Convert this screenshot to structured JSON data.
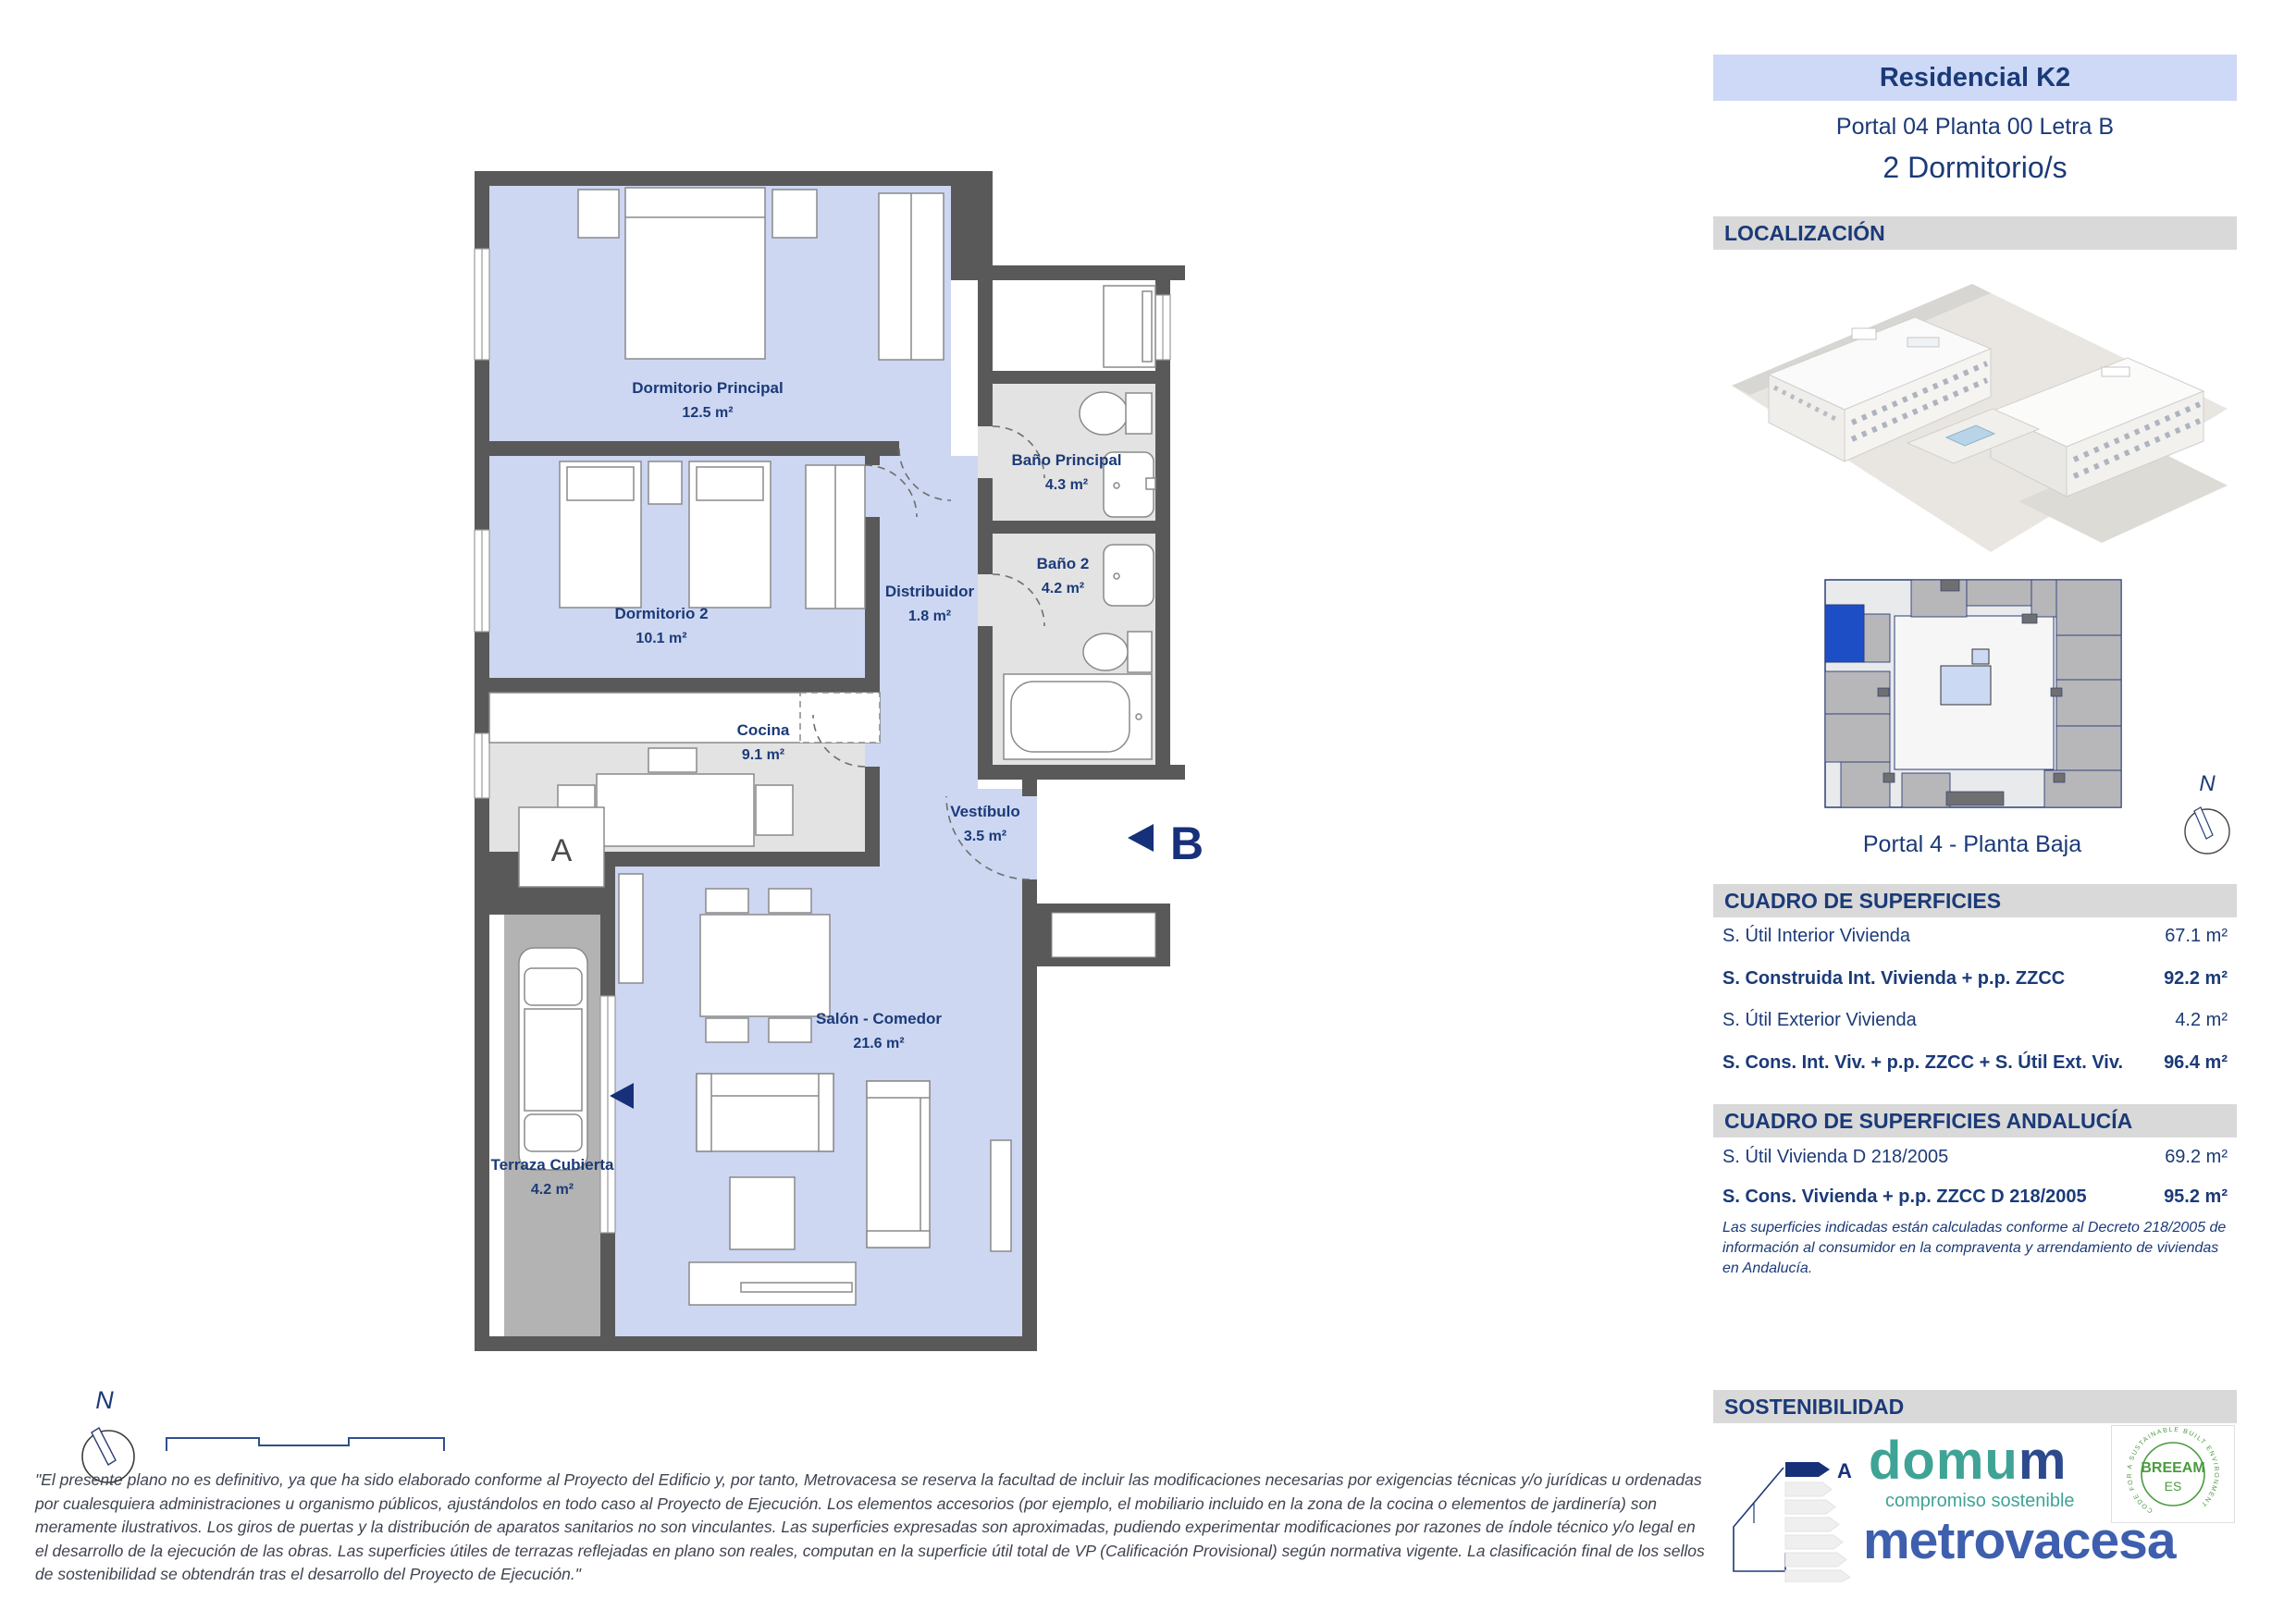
{
  "header": {
    "project": "Residencial K2",
    "unit": "Portal 04 Planta 00 Letra B",
    "bedrooms": "2 Dormitorio/s"
  },
  "sections": {
    "localizacion": "LOCALIZACIÓN",
    "superficies": "CUADRO DE SUPERFICIES",
    "superficies_andalucia": "CUADRO DE SUPERFICIES ANDALUCÍA",
    "sostenibilidad": "SOSTENIBILIDAD"
  },
  "keyplan": {
    "caption": "Portal 4 - Planta Baja",
    "north_label": "N"
  },
  "tables": {
    "main": {
      "rows": [
        {
          "label": "S. Útil Interior Vivienda",
          "value": "67.1 m²"
        },
        {
          "label": "S. Construida Int. Vivienda + p.p. ZZCC",
          "value": "92.2 m²"
        },
        {
          "label": "S. Útil Exterior Vivienda",
          "value": "4.2 m²"
        },
        {
          "label": "S. Cons. Int. Viv. + p.p. ZZCC + S. Útil Ext. Viv.",
          "value": "96.4 m²"
        }
      ]
    },
    "andalucia": {
      "rows": [
        {
          "label": "S. Útil Vivienda D 218/2005",
          "value": "69.2 m²"
        },
        {
          "label": "S. Cons. Vivienda + p.p. ZZCC D 218/2005",
          "value": "95.2 m²"
        }
      ],
      "note": "Las superficies indicadas están calculadas conforme al Decreto 218/2005 de información al consumidor en la compraventa y arrendamiento de viviendas en Andalucía."
    }
  },
  "plan": {
    "north_label": "N",
    "marker_a": "A",
    "marker_b": "B",
    "rooms": [
      {
        "name": "Dormitorio Principal",
        "area": "12.5 m²"
      },
      {
        "name": "Dormitorio 2",
        "area": "10.1 m²"
      },
      {
        "name": "Cocina",
        "area": "9.1 m²"
      },
      {
        "name": "Baño Principal",
        "area": "4.3 m²"
      },
      {
        "name": "Baño 2",
        "area": "4.2 m²"
      },
      {
        "name": "Distribuidor",
        "area": "1.8 m²"
      },
      {
        "name": "Vestíbulo",
        "area": "3.5 m²"
      },
      {
        "name": "Salón - Comedor",
        "area": "21.6 m²"
      },
      {
        "name": "Terraza Cubierta",
        "area": "4.2 m²"
      }
    ]
  },
  "logos": {
    "energy_class": "A",
    "domum": "domu",
    "domum_last": "m",
    "domum_sub": "compromiso sostenible",
    "breeam_line1": "BREEAM",
    "breeam_line2": "ES",
    "breeam_ring": "CODE FOR A SUSTAINABLE BUILT ENVIRONMENT",
    "metrovacesa": "metrovacesa"
  },
  "disclaimer": "\"El presente plano no es definitivo, ya que ha sido elaborado conforme al Proyecto del Edificio y, por tanto, Metrovacesa se reserva la facultad de incluir las modificaciones necesarias por exigencias técnicas y/o jurídicas u ordenadas por cualesquiera administraciones u organismo públicos, ajustándolos en todo caso al Proyecto de Ejecución. Los elementos accesorios (por ejemplo, el mobiliario incluido en la zona de la cocina o elementos de jardinería) son meramente ilustrativos. Los giros de puertas y la distribución de aparatos sanitarios no son vinculantes. Las superficies expresadas son aproximadas, pudiendo experimentar modificaciones por razones de índole técnico y/o legal en el desarrollo de la ejecución de las obras. Las superficies útiles de terrazas reflejadas en plano son reales, computan en la superficie útil total de VP (Calificación Provisional) según normativa vigente. La clasificación final de los sellos de sostenibilidad se obtendrán tras el desarrollo del Proyecto de Ejecución.\"",
  "colors": {
    "navy": "#1b3a78",
    "plan_room_blue": "#cdd7f2",
    "plan_wet_gray": "#e3e3e3",
    "terrace_gray": "#b3b3b3",
    "wall_gray": "#595959",
    "banner_blue": "#cdd9f6",
    "header_gray": "#d9d9d9",
    "keyplan_highlight": "#1e4ec6",
    "domum_teal": "#3fa396",
    "metrovacesa_blue": "#3e5fae",
    "breeam_green": "#4a9b3f"
  }
}
